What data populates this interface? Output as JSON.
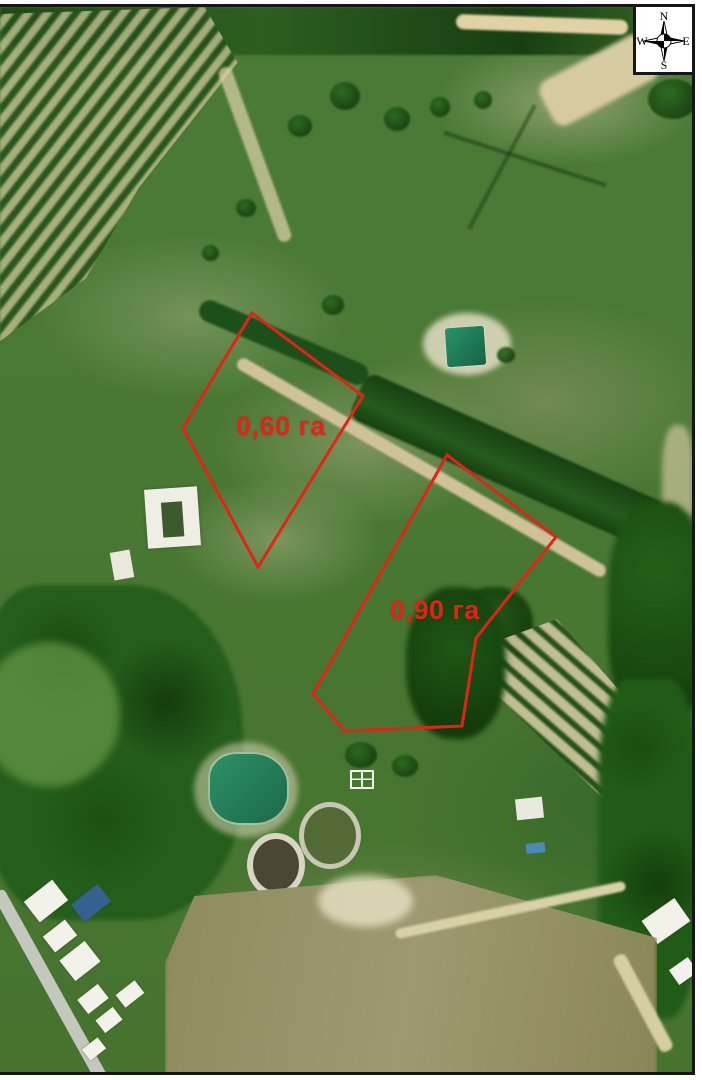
{
  "map": {
    "type": "satellite-annotation",
    "annotation_color": "#e02518",
    "parcels": [
      {
        "label": "0,60 га",
        "points": "252,313 363,396 258,567 183,428"
      },
      {
        "label": "0,90 га",
        "points": "447,455 556,537 476,638 462,726 345,731 313,694"
      }
    ]
  },
  "compass": {
    "north": "N",
    "east": "E",
    "south": "S",
    "west": "W"
  }
}
